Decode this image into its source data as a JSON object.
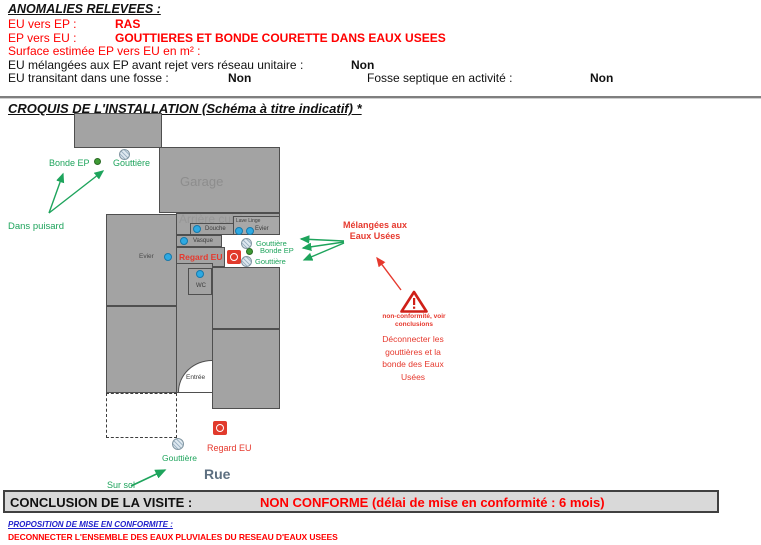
{
  "page": {
    "anomalies_title": "ANOMALIES RELEVEES :",
    "anomalies": [
      {
        "label": "EU vers EP :",
        "value": "RAS"
      },
      {
        "label": "EP vers EU :",
        "value": "GOUTTIERES ET BONDE COURETTE DANS EAUX USEES"
      },
      {
        "label": "Surface estimée EP vers EU en m² :",
        "value": ""
      },
      {
        "label": "EU mélangées aux EP avant rejet vers réseau unitaire :",
        "value": "Non"
      },
      {
        "label": "EU transitant dans une fosse :",
        "value": "Non"
      },
      {
        "label": "Fosse septique en activité :",
        "value": "Non"
      }
    ],
    "croquis_title": "CROQUIS DE L'INSTALLATION (Schéma à titre indicatif) *"
  },
  "diagram": {
    "rooms": {
      "garage": "Garage",
      "arriere_cuisine": "Arrière cuisine",
      "entree": "Entrée"
    },
    "fixtures": {
      "lave_linge": "Lave Linge",
      "evier_right": "Evier",
      "douche": "Douche",
      "vasque": "Vasque",
      "evier_left": "Evier",
      "wc": "WC"
    },
    "labels": {
      "bonde_ep_top": "Bonde EP",
      "gouttiere_top": "Gouttière",
      "dans_puisard": "Dans puisard",
      "regard_eu_court": "Regard EU",
      "gouttiere_court_top": "Gouttière",
      "bonde_ep_court": "Bonde EP",
      "gouttiere_court_bottom": "Gouttière",
      "melangees": "Mélangées aux Eaux Usées",
      "non_conformite": "non-conformité, voir conclusions",
      "deconnecter": "Déconnecter les gouttières et la bonde des Eaux Usées",
      "gouttiere_street": "Gouttière",
      "regard_eu_street": "Regard EU",
      "sur_sol": "Sur sol",
      "rue": "Rue"
    },
    "icons": {
      "drain": "gouttiere-drain-icon",
      "bonde": "bonde-ep-dot-icon",
      "regard": "regard-eu-icon",
      "warning": "warning-triangle-icon",
      "fixture": "fixture-dot-icon"
    }
  },
  "conclusion": {
    "label": "CONCLUSION DE LA VISITE :",
    "value": "NON CONFORME (délai de mise en conformité : 6 mois)"
  },
  "proposition": {
    "title": "PROPOSITION DE MISE EN CONFORMITE :",
    "text": "DECONNECTER L'ENSEMBLE DES EAUX PLUVIALES DU RESEAU D'EAUX USEES"
  },
  "colors": {
    "red_text": "#ff0000",
    "annotation_red": "#e6392e",
    "annotation_green": "#1ea45c",
    "fixture_blue": "#2ea9e2",
    "room_fill": "#a3a3a3",
    "room_text": "#8d8d8d",
    "street_text": "#5d6f80",
    "proposition_blue": "#2222cc",
    "conclusion_bg": "#d9d9d9"
  }
}
